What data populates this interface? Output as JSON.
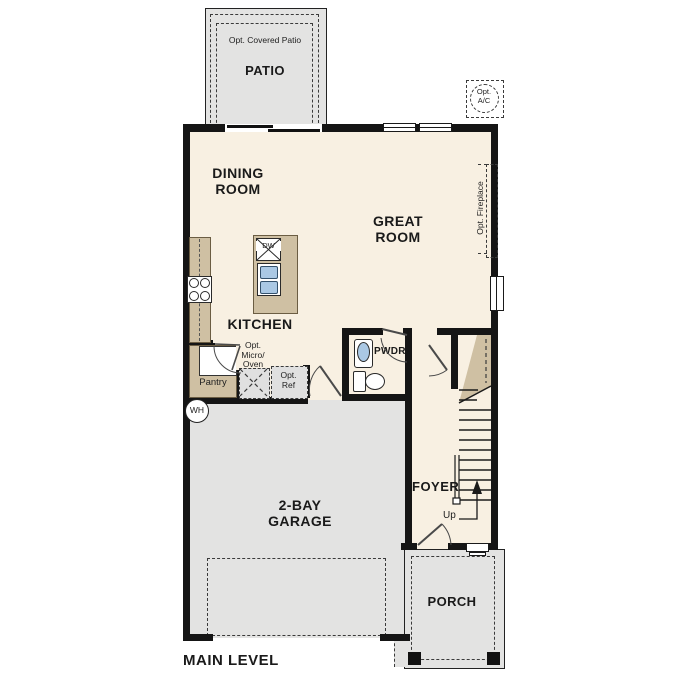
{
  "plan_title": "MAIN LEVEL",
  "labels": {
    "opt_covered_patio": "Opt. Covered Patio",
    "patio": "PATIO",
    "opt_ac_line1": "Opt.",
    "opt_ac_line2": "A/C",
    "dining_line1": "DINING",
    "dining_line2": "ROOM",
    "great_line1": "GREAT",
    "great_line2": "ROOM",
    "opt_fireplace": "Opt. Fireplace",
    "kitchen": "KITCHEN",
    "dw": "DW",
    "pantry": "Pantry",
    "micro_line1": "Opt.",
    "micro_line2": "Micro/",
    "micro_line3": "Oven",
    "ref_line1": "Opt.",
    "ref_line2": "Ref",
    "pwdr": "PWDR",
    "wh": "WH",
    "garage_line1": "2-BAY",
    "garage_line2": "GARAGE",
    "foyer": "FOYER",
    "up": "Up",
    "porch": "PORCH",
    "main_level": "MAIN LEVEL"
  },
  "colors": {
    "wall": "#151515",
    "floor": "#f8f0e2",
    "counter": "#cfc0a3",
    "slab": "#e3e3e2",
    "blue": "#aac8e4"
  }
}
